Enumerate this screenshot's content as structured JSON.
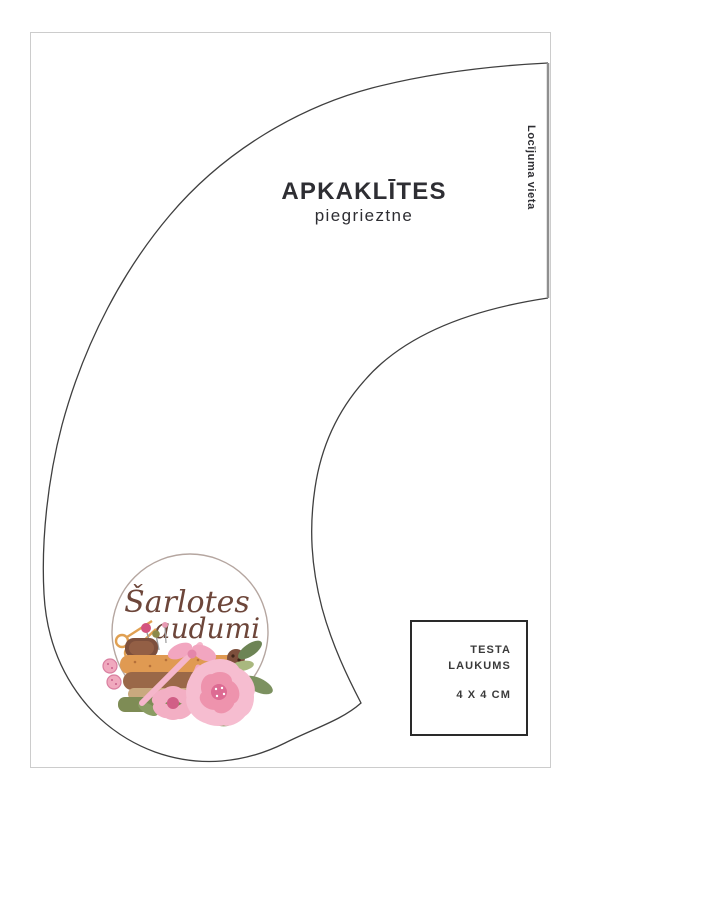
{
  "document": {
    "title": "APKAKLĪTES",
    "subtitle": "piegrieztne",
    "fold_label": "Locījuma vieta"
  },
  "test_square": {
    "label_line1": "TESTA",
    "label_line2": "LAUKUMS",
    "size": "4 X 4 CM"
  },
  "logo": {
    "name_line1": "Šarlotes",
    "name_line2": "audumi"
  },
  "colors": {
    "outline": "#3f3f3f",
    "fold_line": "#8f8f8f",
    "page_border": "#cccccc",
    "text_dark": "#2e2e33",
    "logo_text": "#6d463a",
    "logo_circle": "#b5a6a0"
  }
}
